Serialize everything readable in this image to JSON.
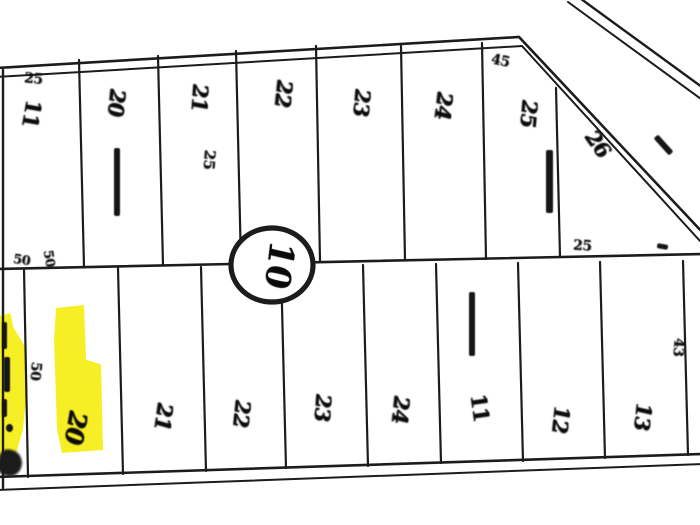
{
  "map": {
    "block_label": "10",
    "top_row_lots": [
      "11",
      "20",
      "21",
      "22",
      "23",
      "24",
      "25",
      "26"
    ],
    "bottom_row_lots": [
      "20",
      "21",
      "22",
      "23",
      "24",
      "11",
      "12",
      "13"
    ],
    "dimensions": {
      "top_left": "25",
      "lot_corner": "25",
      "bend_corner": "45",
      "mid_line": "25",
      "right_edge": "43",
      "mid_left_a": "50",
      "mid_left_b": "50",
      "strip_gap": "50"
    },
    "colors": {
      "highlight": "#f6ec00",
      "ink": "#161616"
    }
  }
}
